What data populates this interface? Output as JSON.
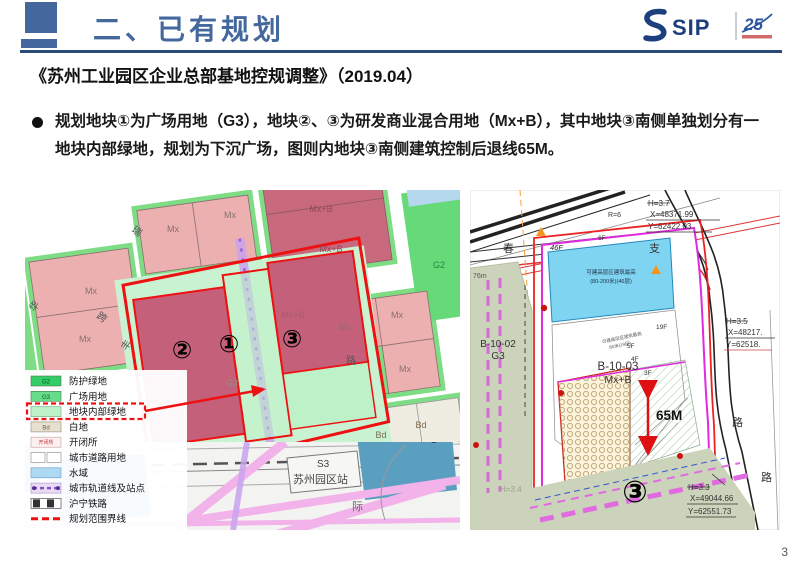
{
  "header": {
    "title": "二、已有规划",
    "logo": {
      "sip": "SIP",
      "anniversary": "25"
    }
  },
  "subtitle": "《苏州工业园区企业总部基地控规调整》（2019.04）",
  "bullet": "规划地块①为广场用地（G3），地块②、③为研发商业混合用地（Mx+B），其中地块③南侧单独划分有一地块内部绿地，规划为下沉广场，图则内地块③南侧建筑控制后退线65M。",
  "page_number": "3",
  "colors": {
    "accent_blue": "#44689e",
    "rule_navy": "#2b4a7a",
    "boundary_red": "#ee1111",
    "parcel_pink_mx": "#ecb0b0",
    "parcel_dark_mxb": "#c4607a",
    "internal_green": "#bdf2c9",
    "verge_green": "#7edc84",
    "g2_green": "#66d979",
    "water_blue": "#aed9f2",
    "station_blue": "#5b9fc0",
    "rail_purple": "#c9a3ef",
    "cad_magenta": "#e02ae0",
    "cad_green_gray": "#cbd3ba",
    "cad_blue_box": "#7fd4f2"
  },
  "left_map": {
    "labels": {
      "mx": "Mx",
      "mxb": "Mx+B",
      "bd": "Bd",
      "g2": "G2",
      "g3": "G3",
      "b": "B",
      "s3": "S3",
      "station": "苏州园区站",
      "plot1": "①",
      "plot2": "②",
      "plot3": "③",
      "road_hua": "华",
      "road_rui": "瑞",
      "road_kua": "跨",
      "road_feng": "丰",
      "road_lu": "路",
      "road_ji": "际"
    },
    "legend": {
      "items": [
        {
          "code": "G2",
          "label": "防护绿地",
          "color": "#33cc66"
        },
        {
          "code": "G3",
          "label": "广场用地",
          "color": "#66dd88"
        },
        {
          "code": "",
          "label": "地块内部绿地",
          "color": "#bdf2c9",
          "highlighted": true
        },
        {
          "code": "Bd",
          "label": "白地",
          "color": "#e6e0d0"
        },
        {
          "code": "开闭所",
          "label": "开闭所",
          "color": "#fdf0f0"
        },
        {
          "code": "",
          "label": "城市道路用地",
          "color": "#ffffff"
        },
        {
          "code": "",
          "label": "水域",
          "color": "#aed9f2"
        },
        {
          "code": "",
          "label": "城市轨道线及站点",
          "color": "#8a4fc8"
        },
        {
          "code": "",
          "label": "沪宁铁路",
          "color": "#333333"
        },
        {
          "code": "",
          "label": "规划范围界线",
          "color": "#ee1111"
        }
      ]
    }
  },
  "right_map": {
    "labels": {
      "parcel1": "B-10-03",
      "parcel1_use": "Mx+B",
      "parcel2": "B-10-02",
      "parcel2_use": "G3",
      "plot3": "③",
      "dim": "65M",
      "f46": "46F",
      "f19": "19F",
      "f6": "6F",
      "f5": "5F",
      "f4": "4F",
      "f3": "3F",
      "r6": "R=6",
      "d76": "76m",
      "h34": "H=3.4",
      "road_chun": "春",
      "road_zhi": "支",
      "road_lu1": "路",
      "road_lu2": "路",
      "note46_l1": "可建高层区建筑最高",
      "note46_l2": "(80-200米)(46层)",
      "note19_l1": "可建高层区建筑最高",
      "note19_l2": "80米(19层)"
    },
    "callouts": [
      {
        "h": "H=3.7",
        "x": "X=48371.99",
        "y": "Y=62422.03"
      },
      {
        "h": "H=3.5",
        "x": "X=48217.",
        "y": "Y=62518."
      },
      {
        "h": "H=3.3",
        "x": "X=49044.66",
        "y": "Y=62551.73"
      }
    ]
  }
}
